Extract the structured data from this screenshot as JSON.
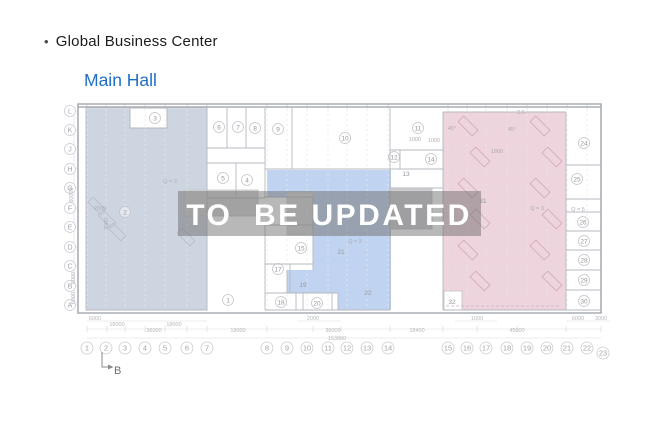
{
  "header": {
    "bullet": "•",
    "title": "Global Business Center",
    "subtitle": "Main Hall",
    "subtitle_color": "#1f6ec6"
  },
  "watermark": {
    "text": "TO  BE UPDATED",
    "band_color": "#6b6b6b",
    "text_color": "#ffffff"
  },
  "plan": {
    "colors": {
      "left_region": "#cdd5e1",
      "middle_region": "#c0d3f0",
      "right_region": "#edd4dd",
      "wall": "#b5b9bf",
      "outer_wall": "#a9adb3",
      "grid": "#e7e9ed",
      "axis_stroke": "#cbccd0",
      "axis_text": "#a3a4a9",
      "room_stroke": "#c3c4c8",
      "room_text": "#96979d",
      "dim_text": "#b7b8bd",
      "annotation_text": "#b2abb2",
      "marker_text": "#6f7073"
    },
    "axis_letters": [
      "L",
      "K",
      "J",
      "H",
      "G",
      "F",
      "E",
      "D",
      "C",
      "B",
      "A"
    ],
    "axis_numbers": [
      "1",
      "2",
      "3",
      "4",
      "5",
      "6",
      "7",
      "8",
      "9",
      "10",
      "11",
      "12",
      "13",
      "14",
      "15",
      "16",
      "17",
      "18",
      "19",
      "20",
      "21",
      "22",
      "23"
    ],
    "rooms_circled": [
      {
        "n": "1",
        "x": 228,
        "y": 300
      },
      {
        "n": "2",
        "x": 125,
        "y": 212
      },
      {
        "n": "3",
        "x": 155,
        "y": 118
      },
      {
        "n": "4",
        "x": 247,
        "y": 180
      },
      {
        "n": "5",
        "x": 223,
        "y": 178
      },
      {
        "n": "6",
        "x": 219,
        "y": 127
      },
      {
        "n": "7",
        "x": 238,
        "y": 127
      },
      {
        "n": "8",
        "x": 255,
        "y": 128
      },
      {
        "n": "9",
        "x": 278,
        "y": 129
      },
      {
        "n": "10",
        "x": 345,
        "y": 138
      },
      {
        "n": "11",
        "x": 418,
        "y": 128
      },
      {
        "n": "12",
        "x": 394,
        "y": 157
      },
      {
        "n": "14",
        "x": 431,
        "y": 159
      },
      {
        "n": "15",
        "x": 301,
        "y": 248
      },
      {
        "n": "17",
        "x": 278,
        "y": 269
      },
      {
        "n": "18",
        "x": 281,
        "y": 302
      },
      {
        "n": "20",
        "x": 317,
        "y": 303
      },
      {
        "n": "24",
        "x": 584,
        "y": 143
      },
      {
        "n": "25",
        "x": 577,
        "y": 179
      },
      {
        "n": "26",
        "x": 583,
        "y": 222
      },
      {
        "n": "27",
        "x": 584,
        "y": 241
      },
      {
        "n": "28",
        "x": 584,
        "y": 260
      },
      {
        "n": "29",
        "x": 584,
        "y": 280
      },
      {
        "n": "30",
        "x": 584,
        "y": 301
      }
    ],
    "rooms_plain": [
      {
        "n": "13",
        "x": 406,
        "y": 174
      },
      {
        "n": "19",
        "x": 303,
        "y": 285
      },
      {
        "n": "21",
        "x": 341,
        "y": 252
      },
      {
        "n": "22",
        "x": 368,
        "y": 293
      },
      {
        "n": "31",
        "x": 483,
        "y": 201
      },
      {
        "n": "32",
        "x": 452,
        "y": 302
      }
    ],
    "annotations": [
      {
        "t": "Q = 3",
        "x": 170,
        "y": 183
      },
      {
        "t": "Q = 3",
        "x": 355,
        "y": 243
      },
      {
        "t": "Q = 3",
        "x": 537,
        "y": 210
      },
      {
        "t": "Q = 5",
        "x": 578,
        "y": 211
      },
      {
        "t": "45°",
        "x": 452,
        "y": 130
      },
      {
        "t": "45°",
        "x": 512,
        "y": 131
      },
      {
        "t": "2.5",
        "x": 521,
        "y": 114
      },
      {
        "t": "2000",
        "x": 100,
        "y": 210
      },
      {
        "t": "1000",
        "x": 434,
        "y": 142
      },
      {
        "t": "1000",
        "x": 415,
        "y": 141
      },
      {
        "t": "1800",
        "x": 497,
        "y": 153
      },
      {
        "t": "3000",
        "x": 108,
        "y": 224,
        "rot": true
      }
    ],
    "dimensions": [
      {
        "t": "6000",
        "x": 95,
        "y": 320
      },
      {
        "t": "18000",
        "x": 117,
        "y": 326
      },
      {
        "t": "18000",
        "x": 174,
        "y": 326
      },
      {
        "t": "36000",
        "x": 154,
        "y": 332
      },
      {
        "t": "18000",
        "x": 238,
        "y": 332
      },
      {
        "t": "2000",
        "x": 313,
        "y": 320
      },
      {
        "t": "36000",
        "x": 333,
        "y": 332
      },
      {
        "t": "153880",
        "x": 337,
        "y": 340
      },
      {
        "t": "18400",
        "x": 417,
        "y": 332
      },
      {
        "t": "1000",
        "x": 477,
        "y": 320
      },
      {
        "t": "45000",
        "x": 517,
        "y": 332
      },
      {
        "t": "6000",
        "x": 578,
        "y": 320
      },
      {
        "t": "3000",
        "x": 601,
        "y": 320
      },
      {
        "t": "60000",
        "x": 73,
        "y": 195,
        "rot": true
      },
      {
        "t": "6000",
        "x": 75,
        "y": 278,
        "rot": true
      },
      {
        "t": "6000",
        "x": 75,
        "y": 298,
        "rot": true
      }
    ],
    "section_marker": {
      "label": "B"
    }
  }
}
